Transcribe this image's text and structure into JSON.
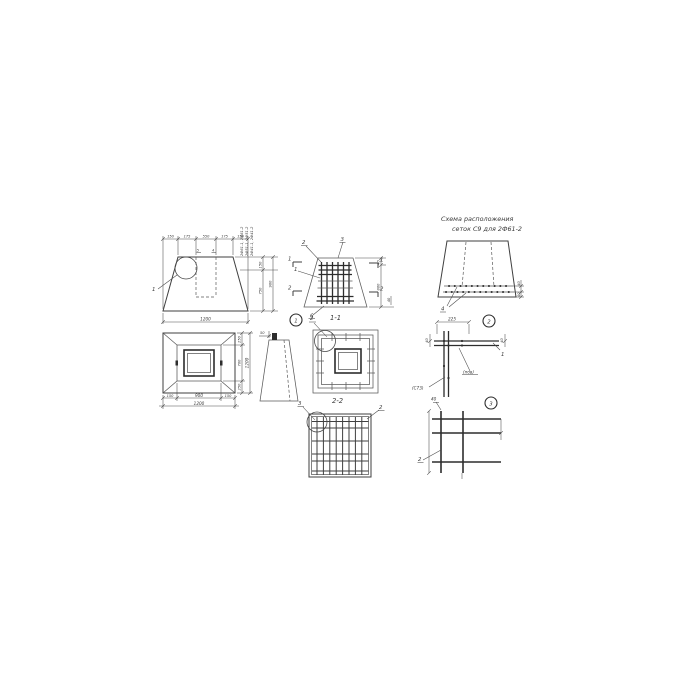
{
  "palette": {
    "background": "#ffffff",
    "line": "#4f4f4f",
    "bar": "#2d2d2d",
    "text": "#3a3a3a"
  },
  "mesh_scheme": {
    "title_line1": "Схема  расположения",
    "title_line2": "сеток С9    для 2Ф61-2",
    "leader": "4",
    "dim_right_top": "40",
    "dim_right_bottom": "40"
  },
  "front": {
    "callout": "1",
    "label_5": "5",
    "label_4": "4",
    "dims_top": [
      "150",
      "175",
      "550",
      "175",
      "150"
    ],
    "dim_bottom": "1200",
    "dim_right_1": "150",
    "dim_right_2": "750",
    "dim_right_total": "900",
    "type_marks": [
      "2Ф61-1, 2Ф61-2",
      "2Ф51-1, 2Ф51-2",
      "2Ф41-1, 2Ф41-2"
    ]
  },
  "reinforcement": {
    "mark_left_1": "1",
    "mark_left_2": "2",
    "mark_right_1": "1",
    "mark_right_2": "2",
    "leader_top_1": "2",
    "leader_top_2": "3",
    "leader_left": "1",
    "leader_bottom": "6",
    "dim_right_1": "40",
    "dim_right_2": "860",
    "dim_far_right": "40"
  },
  "plan": {
    "dim_bottom_1": "150",
    "dim_bottom_2": "900",
    "dim_bottom_3": "150",
    "dim_bottom_total": "1200",
    "dim_right_1": "250",
    "dim_right_2": "700",
    "dim_right_3": "250",
    "dim_right_total": "1200"
  },
  "side_sketch": {
    "dim_top": "50"
  },
  "section11": {
    "callout": "1",
    "leader": "2",
    "title": "1-1"
  },
  "corner_detail": {
    "dim_top": "225",
    "callout": "2",
    "dim_left": "40",
    "dim_right": "40",
    "leader": "1",
    "label_left": "(С73)",
    "label_right": "(пов)"
  },
  "section22": {
    "leader_left": "3",
    "title": "2-2",
    "leader_right": "2"
  },
  "grid_detail": {
    "callout": "3",
    "dim_top": "40",
    "leader": "2"
  }
}
